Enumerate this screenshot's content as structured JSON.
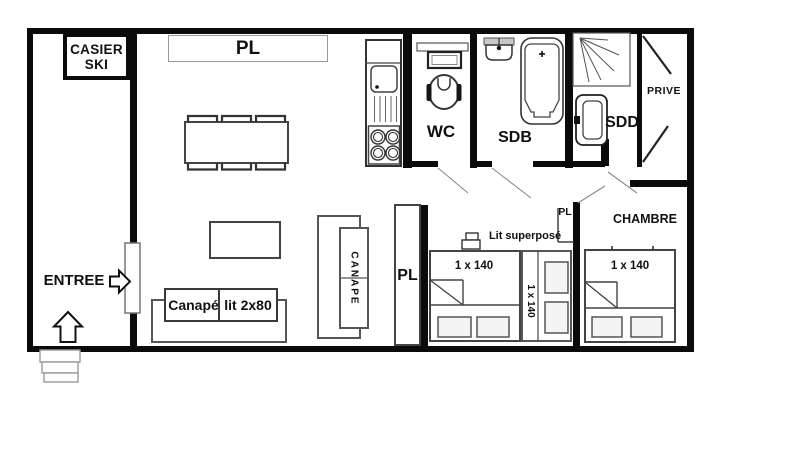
{
  "floorplan": {
    "entry": {
      "label": "ENTREE",
      "casier": {
        "line1": "CASIER",
        "line2": "SKI"
      }
    },
    "living": {
      "closet_top": "PL",
      "closet_tall": "PL",
      "sofa_bed": {
        "part1": "Canapé",
        "part2": "lit 2x80"
      },
      "sofa_vertical": "CANAPE"
    },
    "bathrooms": {
      "wc": "WC",
      "bath": "SDB",
      "shower_room": "SDD"
    },
    "private_room": "PRIVE",
    "bedroom": {
      "name": "CHAMBRE",
      "closet": "PL",
      "bed": "1 x 140"
    },
    "alcove": {
      "bunk_caption": "Lit superposé",
      "bed": "1 x 140",
      "bunk_bed": "1 x 140"
    }
  },
  "colors": {
    "walls": "#0b0b0b",
    "furniture_outline": "#444444",
    "light_outline": "#999999",
    "background": "#ffffff",
    "text": "#111111"
  }
}
